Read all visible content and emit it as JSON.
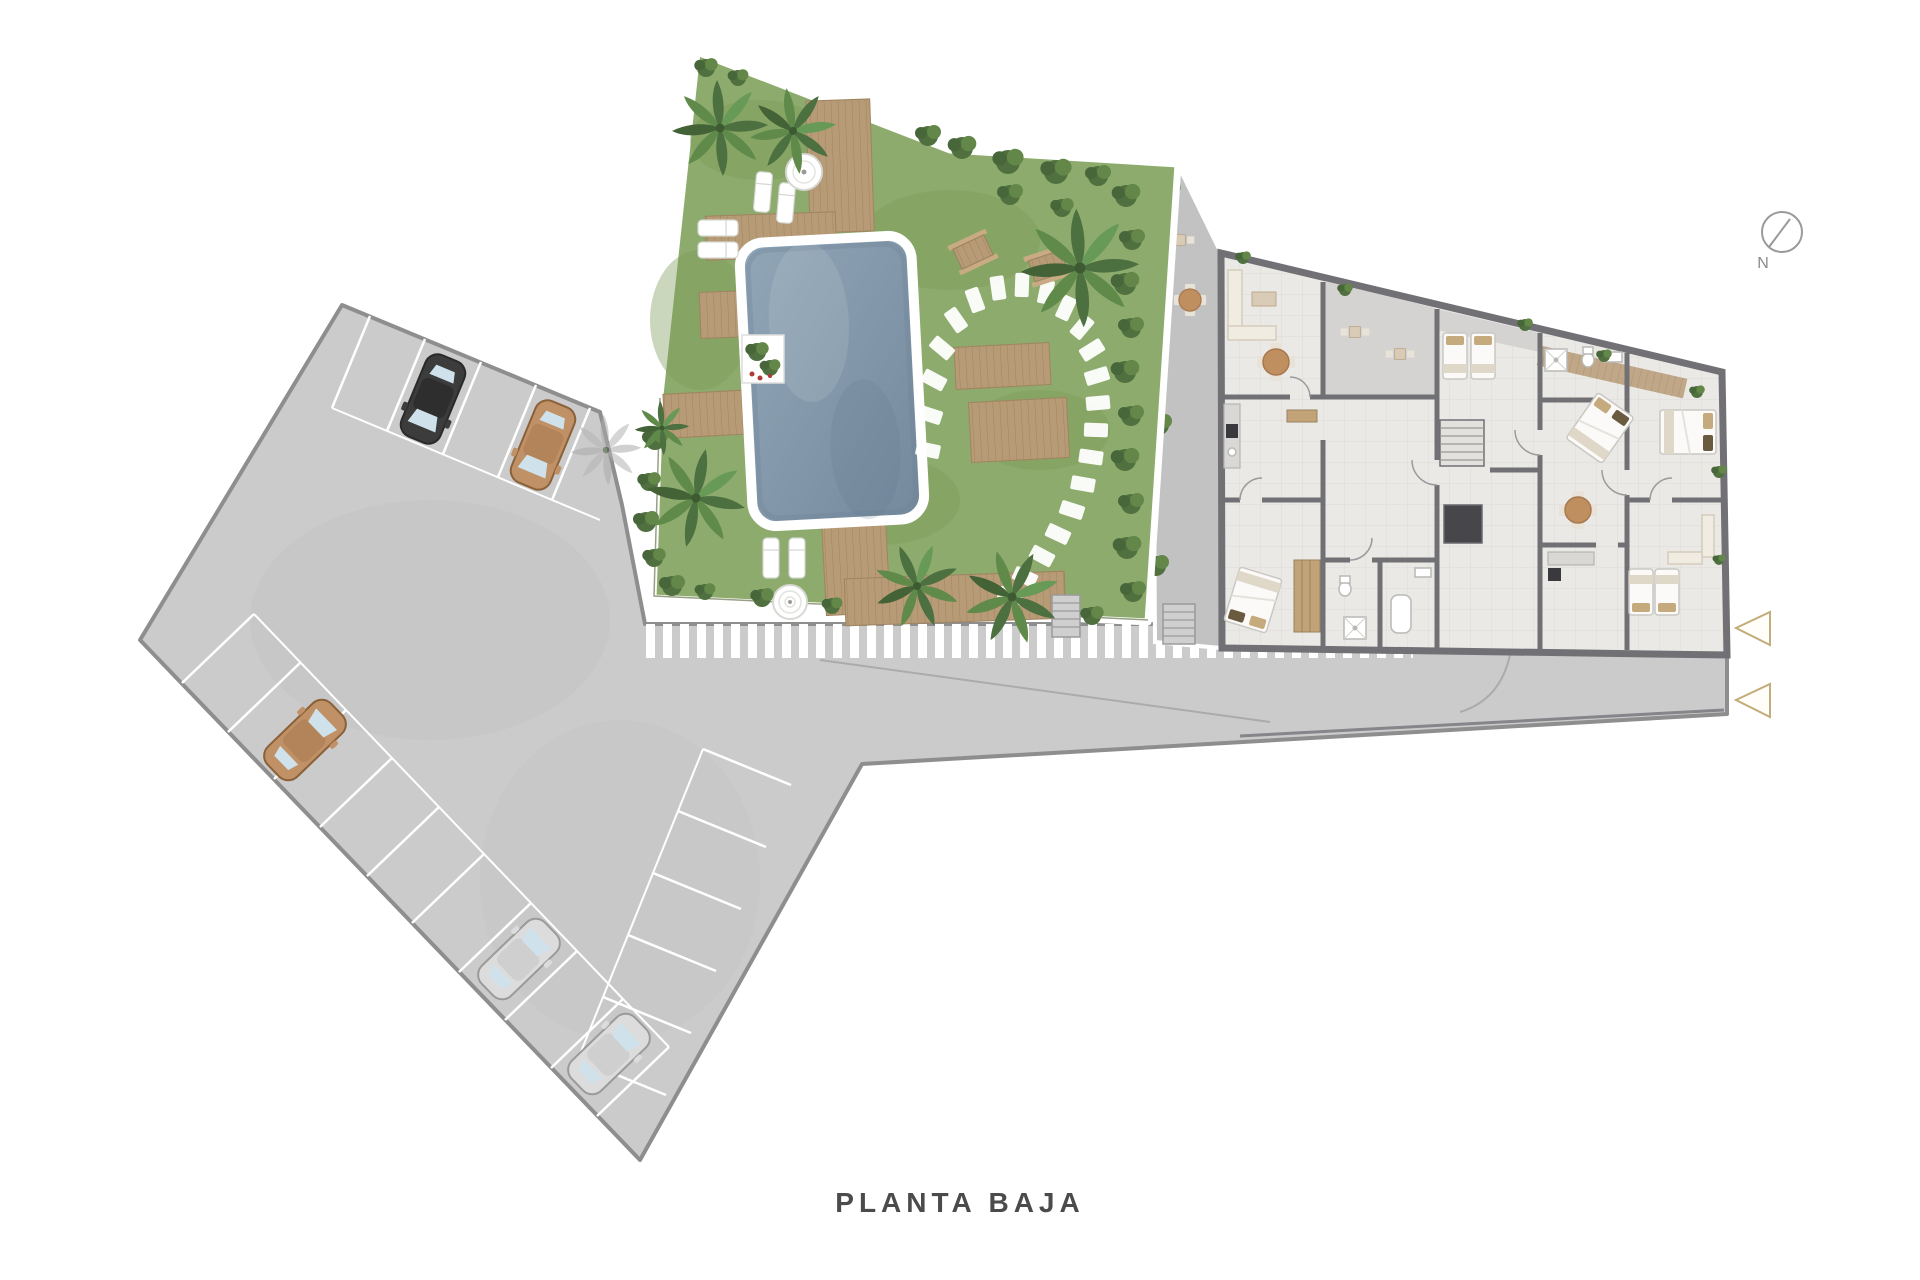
{
  "page": {
    "background": "#ffffff"
  },
  "title": {
    "label": "PLANTA BAJA"
  },
  "compass": {
    "label": "N"
  },
  "plan": {
    "floor_name": "PLANTA BAJA",
    "areas": [
      "parking-lot",
      "garden",
      "swimming-pool",
      "apartment-building",
      "entry-patio",
      "driveway",
      "pedestrian-crosswalk"
    ],
    "parking": {
      "rows": 3,
      "cars": [
        {
          "id": "car-1",
          "color_name": "black",
          "hex": "#3c3c3c",
          "row": "top"
        },
        {
          "id": "car-2",
          "color_name": "tan",
          "hex": "#c09066",
          "row": "top"
        },
        {
          "id": "car-3",
          "color_name": "tan",
          "hex": "#c09066",
          "row": "bottom-left"
        },
        {
          "id": "car-4",
          "color_name": "silver",
          "hex": "#dcdcdc",
          "row": "bottom-left"
        },
        {
          "id": "car-5",
          "color_name": "silver",
          "hex": "#dcdcdc",
          "row": "bottom-left"
        }
      ]
    },
    "garden": {
      "features": [
        "palm-trees",
        "swimming-pool",
        "wood-decks",
        "pool-bridge",
        "sun-loungers",
        "parasol",
        "fountain",
        "stepping-stone-path",
        "picnic-tables",
        "planter",
        "hedge"
      ]
    },
    "building": {
      "features": [
        "apartments",
        "beds",
        "sofas",
        "dining-tables",
        "kitchens",
        "bathrooms",
        "stairs",
        "elevator",
        "terraces"
      ]
    },
    "entrance_arrows": {
      "count": 2,
      "direction": "left",
      "color": "#c3ac7a"
    },
    "palette": {
      "pavement": "#cbcbcb",
      "pavement_edge": "#8e8e8e",
      "patio": "#c2c2c2",
      "grass": "#8dab6c",
      "grass_shade": "#7e9c5b",
      "hedge": "#50713f",
      "pool_water": "#8ca3b6",
      "pool_deep": "#74899c",
      "pool_rim": "#ffffff",
      "wood": "#b79b77",
      "wood_line": "#a08460",
      "floor": "#eae9e6",
      "wall": "#717175",
      "terrace": "#d4d3d1",
      "bed_linen": "#fbfaf8",
      "pillow": "#c5aa7e",
      "table_wood": "#c08f5f",
      "car_black": "#3c3c3c",
      "car_tan": "#c09066",
      "car_silver": "#dcdcdc",
      "arrow": "#c3ac7a",
      "label_text": "#4b4b4b",
      "compass": "#8b8b8b"
    }
  }
}
